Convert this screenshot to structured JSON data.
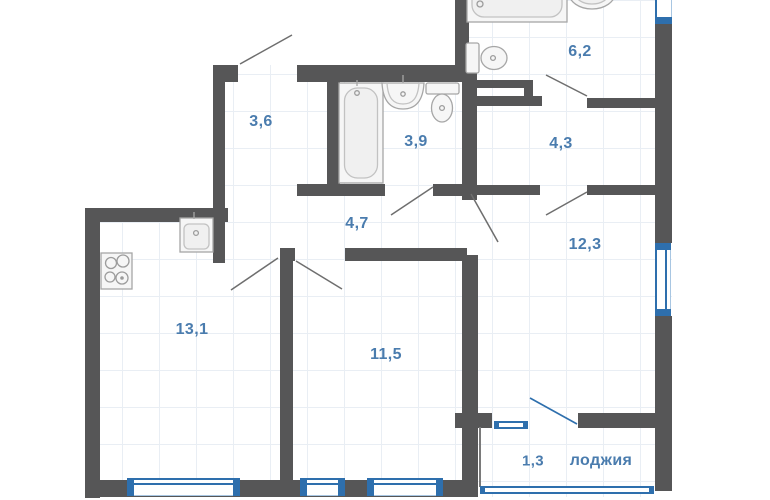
{
  "plan": {
    "type": "apartment-floor-plan",
    "rooms": [
      {
        "id": "wardrobe",
        "area_m2": "3,6"
      },
      {
        "id": "bathroom",
        "area_m2": "3,9"
      },
      {
        "id": "bathroom-top",
        "area_m2": "6,2"
      },
      {
        "id": "hallway",
        "area_m2": "4,3"
      },
      {
        "id": "corridor",
        "area_m2": "4,7"
      },
      {
        "id": "room-right",
        "area_m2": "12,3"
      },
      {
        "id": "kitchen-living",
        "area_m2": "13,1"
      },
      {
        "id": "room-center",
        "area_m2": "11,5"
      },
      {
        "id": "loggia",
        "area_m2": "1,3",
        "label": "лоджия"
      }
    ],
    "fixtures": [
      "bathtub-vertical",
      "bathtub-horizontal",
      "washbasin-pedestal",
      "washbasin-round",
      "toilet",
      "toilet-2",
      "kitchen-sink",
      "cooktop"
    ],
    "colors": {
      "wall": "#565657",
      "window": "#2e6fad",
      "room_label": "#4a7cae",
      "door_line": "#6e6e6e",
      "fixture_outline": "#a6a6a6",
      "floor_grid": "#e9eef4"
    }
  }
}
